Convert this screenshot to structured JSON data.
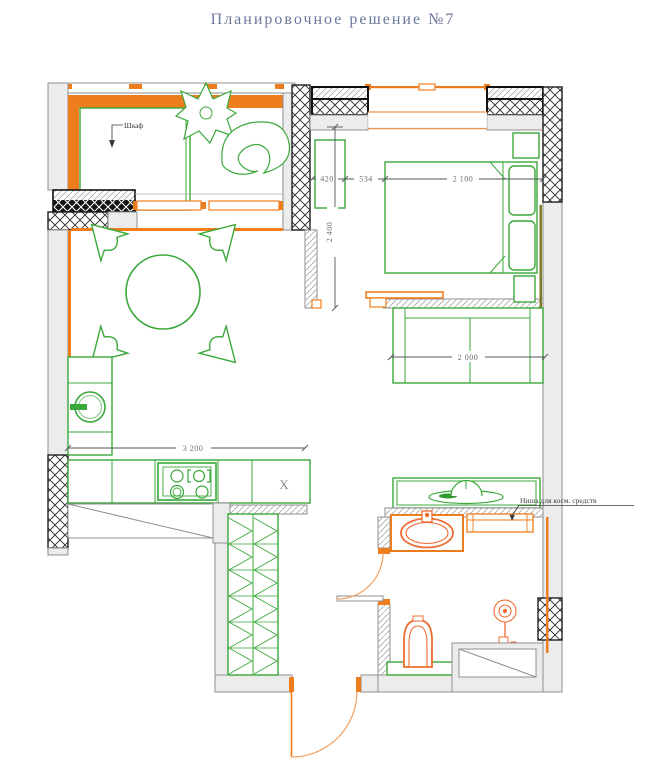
{
  "title": "Планировочное решение №7",
  "labels": {
    "wardrobe": "Шкаф",
    "cosmetics_niche": "Ниша для косм. средств",
    "x_mark": "X"
  },
  "dimensions": {
    "balcony_unit_width": "420",
    "gap_width": "534",
    "bed_zone_width": "2 100",
    "bedroom_depth": "2 400",
    "wardrobe_width": "2 000",
    "kitchen_width": "3 200"
  },
  "colors": {
    "wall_gray": "#ececec",
    "accent_orange": "#ee7d1e",
    "fixture_orange": "#ef6c30",
    "furniture_green": "#3aa83a",
    "title_color": "#6a7899",
    "dimension_color": "#6e6e76"
  }
}
